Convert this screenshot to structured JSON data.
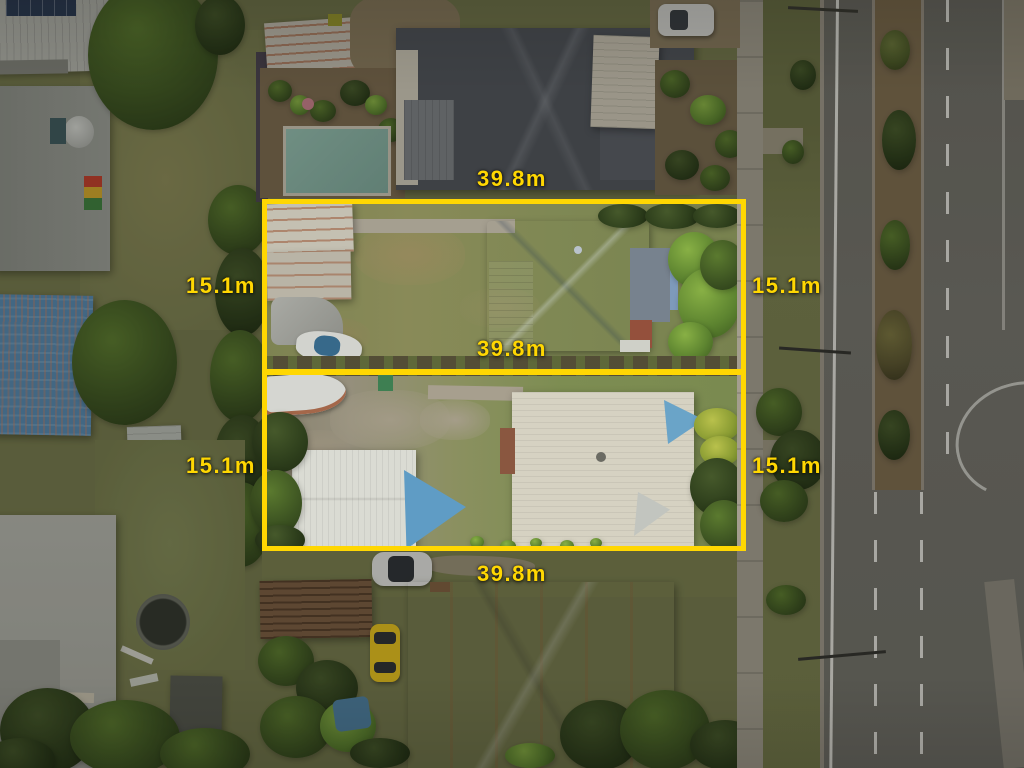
{
  "annotation": {
    "accent_color": "#FFD702",
    "labels": {
      "top_width": "39.8m",
      "middle_width": "39.8m",
      "bottom_width": "39.8m",
      "lot1_left_depth": "15.1m",
      "lot1_right_depth": "15.1m",
      "lot2_left_depth": "15.1m",
      "lot2_right_depth": "15.1m"
    },
    "lots": [
      {
        "name": "upper lot",
        "width": "39.8m",
        "depth": "15.1m"
      },
      {
        "name": "lower lot",
        "width": "39.8m",
        "depth": "15.1m"
      }
    ]
  },
  "scene": {
    "type": "aerial-drone-photograph",
    "description": "Two adjoining suburban residential lots outlined in yellow with dimension labels, neighbouring houses left and top, a divided main road on the right",
    "palette": {
      "annotation_yellow": "#FFD702",
      "road_asphalt": "#706F68",
      "median_soil": "#7C6B4E",
      "footpath_concrete": "#A49E8F",
      "lawn_olive": "#7F8352",
      "blue_metal_roof": "#7E9ABA",
      "cream_metal_roof": "#D6D2C2",
      "slate_roof": "#50545B",
      "pool_water": "#8CB3A3",
      "shade_sail_blue": "#5F9CC5",
      "yellow_car": "#E3BF1E"
    }
  }
}
